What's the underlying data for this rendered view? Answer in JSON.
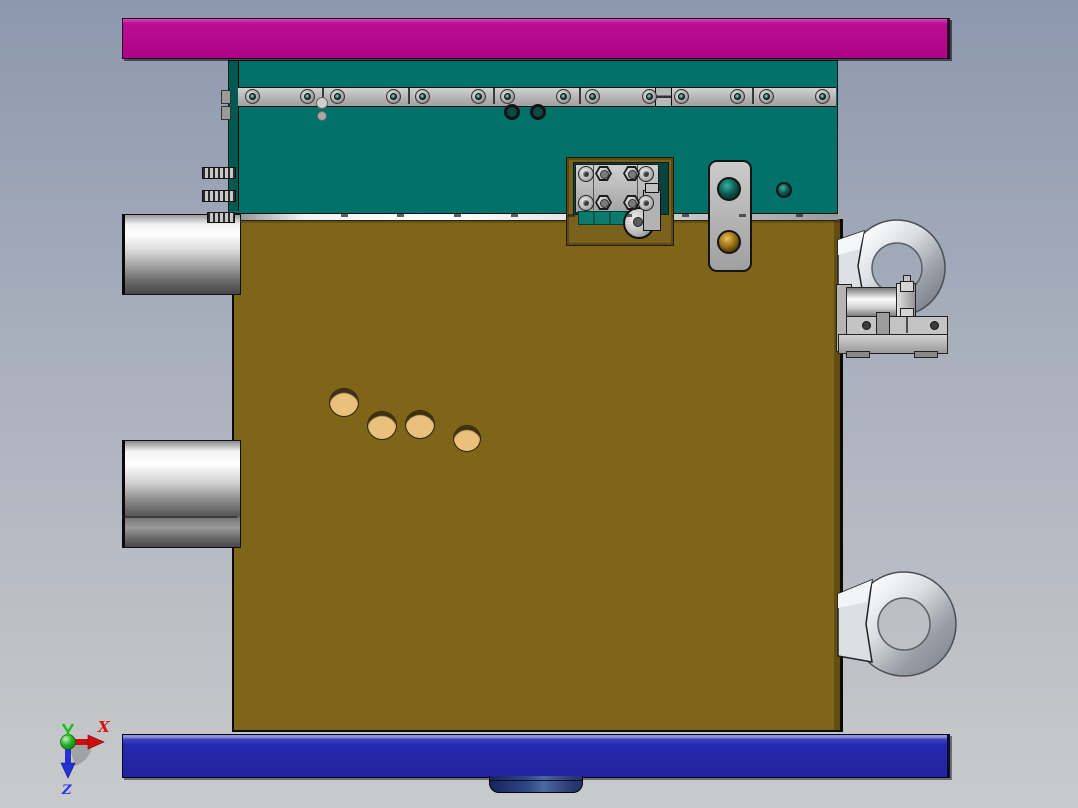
{
  "scene": {
    "description": "3D CAD side view of an injection mold assembly with lifting eyebolts"
  },
  "triad": {
    "x_label": "X",
    "z_label": "Z"
  },
  "palette": {
    "bg_top": "#8c98ae",
    "bg_mid": "#aab0bd",
    "bg_bottom": "#c9cacb",
    "top_clamp": "#ad0387",
    "cavity_plate": "#007169",
    "cavity_edge": "#015951",
    "core_plate": "#7f6518",
    "bottom_clamp": "#2428ab",
    "bottom_clamp_hi": "#8d93d8",
    "rail": "#b9b9b9",
    "pocket_frame": "#7a611c",
    "pocket_recess": "#0a433d",
    "pin_tan": "#e9c17d",
    "axis_x": "#d40000",
    "axis_y": "#1db41d",
    "axis_z": "#2230d8"
  },
  "model": {
    "rail": {
      "x": 238,
      "y": 87,
      "w": 598,
      "h": 18,
      "screws_x": [
        252,
        307,
        337,
        393,
        422,
        478,
        507,
        563,
        592,
        649,
        681,
        737,
        766,
        822
      ],
      "dividers_x": [
        322,
        408,
        493,
        579,
        670,
        752
      ],
      "box": {
        "x": 655,
        "y": 87,
        "w": 15,
        "h": 18
      }
    },
    "parting_ticks_x": [
      341,
      397,
      454,
      511,
      568,
      625,
      682,
      739,
      796
    ],
    "core_holes": [
      {
        "x": 343,
        "y": 402,
        "r": 14
      },
      {
        "x": 381,
        "y": 425,
        "r": 14
      },
      {
        "x": 419,
        "y": 424,
        "r": 14
      },
      {
        "x": 466,
        "y": 438,
        "r": 13
      }
    ],
    "cavity_rings": [
      {
        "x": 512,
        "y": 112
      },
      {
        "x": 538,
        "y": 112
      }
    ],
    "cavity_hole": {
      "x": 783,
      "y": 189,
      "r": 7
    },
    "misc_dots": [
      {
        "x": 316,
        "y": 97,
        "d": 10,
        "c": "#cfcfcf"
      },
      {
        "x": 317,
        "y": 111,
        "d": 8,
        "c": "#a8a8a8"
      }
    ],
    "latch_holes": [
      {
        "x": 728,
        "y": 188,
        "r": 11,
        "type": "teal"
      },
      {
        "x": 728,
        "y": 241,
        "r": 11,
        "type": "gold"
      }
    ],
    "pocket_sockets": [
      {
        "x": 586,
        "y": 174
      },
      {
        "x": 646,
        "y": 174
      },
      {
        "x": 586,
        "y": 203
      },
      {
        "x": 646,
        "y": 203
      }
    ],
    "pocket_nuts": [
      {
        "x": 604,
        "y": 174
      },
      {
        "x": 632,
        "y": 174
      },
      {
        "x": 604,
        "y": 203
      },
      {
        "x": 632,
        "y": 203
      }
    ],
    "pins": [
      {
        "x": 202,
        "y": 167,
        "w": 32,
        "h": 10
      },
      {
        "x": 202,
        "y": 190,
        "w": 32,
        "h": 10
      },
      {
        "x": 207,
        "y": 212,
        "w": 26,
        "h": 9
      }
    ],
    "edge_tabs": [
      {
        "x": 221,
        "y": 90
      },
      {
        "x": 221,
        "y": 106
      }
    ]
  }
}
